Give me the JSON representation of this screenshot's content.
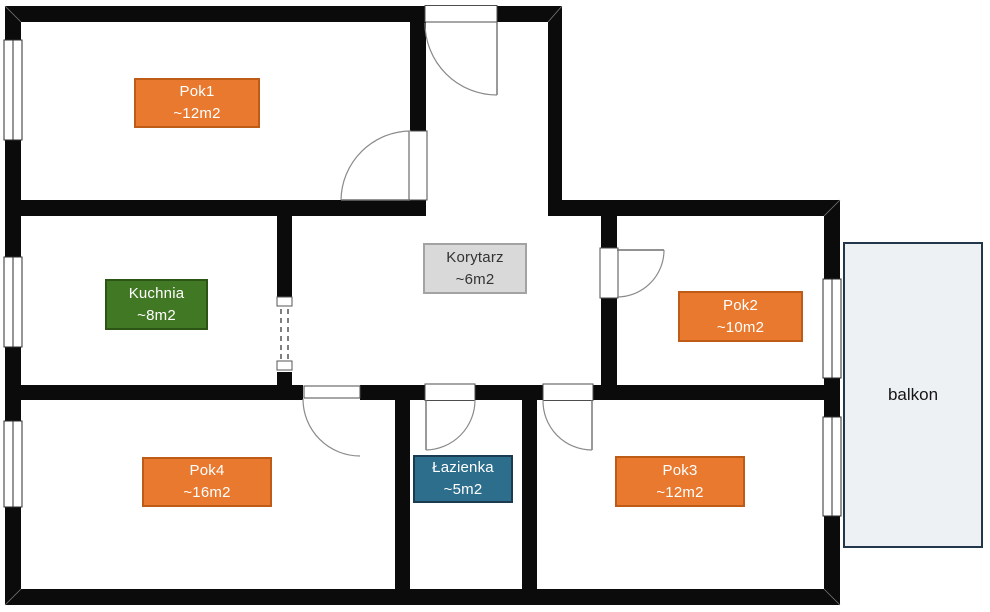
{
  "floorplan": {
    "wall_color": "#0B0B0B",
    "rooms": [
      {
        "name": "Pok1",
        "area": "~12m2",
        "fill": "#E8792E",
        "border": "#BE5B17",
        "text": "#FFFFFF"
      },
      {
        "name": "Kuchnia",
        "area": "~8m2",
        "fill": "#417823",
        "border": "#2C5414",
        "text": "#FFFFFF"
      },
      {
        "name": "Korytarz",
        "area": "~6m2",
        "fill": "#D9D9D9",
        "border": "#A3A3A3",
        "text": "#333333"
      },
      {
        "name": "Pok2",
        "area": "~10m2",
        "fill": "#E8792E",
        "border": "#BE5B17",
        "text": "#FFFFFF"
      },
      {
        "name": "Pok4",
        "area": "~16m2",
        "fill": "#E8792E",
        "border": "#BE5B17",
        "text": "#FFFFFF"
      },
      {
        "name": "Łazienka",
        "area": "~5m2",
        "fill": "#2D6E8C",
        "border": "#1A3B50",
        "text": "#FFFFFF"
      },
      {
        "name": "Pok3",
        "area": "~12m2",
        "fill": "#E8792E",
        "border": "#BE5B17",
        "text": "#FFFFFF"
      }
    ],
    "balcony": {
      "name": "balkon",
      "fill": "#EEF1F4",
      "border": "#22384A",
      "text": "#151515"
    }
  }
}
